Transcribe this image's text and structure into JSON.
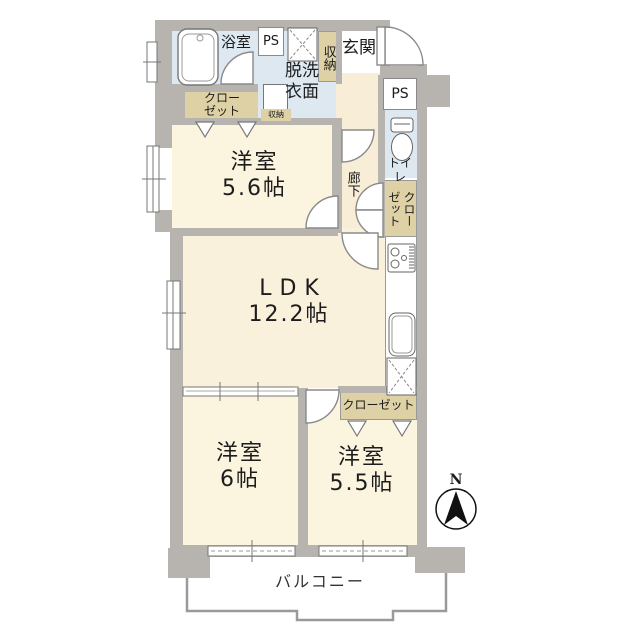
{
  "title": "apartment-floor-plan",
  "colors": {
    "wall_gray": "#b7b3af",
    "room_cream": "#fbf5e0",
    "corridor_cream": "#f8edd6",
    "wet_area_blue": "#dde8f1",
    "closet_beige": "#ddd1a5",
    "outline": "#8a8a8a"
  },
  "rooms": {
    "bath": {
      "label": "浴室"
    },
    "ps_top": {
      "label": "PS"
    },
    "laundry": {
      "line1": "脱洗",
      "line2": "衣面"
    },
    "entry_storage": {
      "label": "収納"
    },
    "entrance": {
      "label": "玄関"
    },
    "closet_nw": {
      "line1": "クロー",
      "line2": "ゼット"
    },
    "small_storage": {
      "label": "収納"
    },
    "ps_right": {
      "label": "PS"
    },
    "toilet": {
      "label": "トイレ"
    },
    "corridor": {
      "label": "廊下"
    },
    "closet_east": {
      "label": "クローゼット"
    },
    "bedroom_nw": {
      "name": "洋室",
      "size": "5.6帖"
    },
    "ldk": {
      "name": "LDK",
      "size": "12.2帖"
    },
    "bedroom_sw": {
      "name": "洋室",
      "size": "6帖"
    },
    "bedroom_se": {
      "name": "洋室",
      "size": "5.5帖"
    },
    "closet_se": {
      "label": "クローゼット"
    },
    "balcony": {
      "label": "バルコニー"
    },
    "compass": {
      "label": "N"
    }
  }
}
